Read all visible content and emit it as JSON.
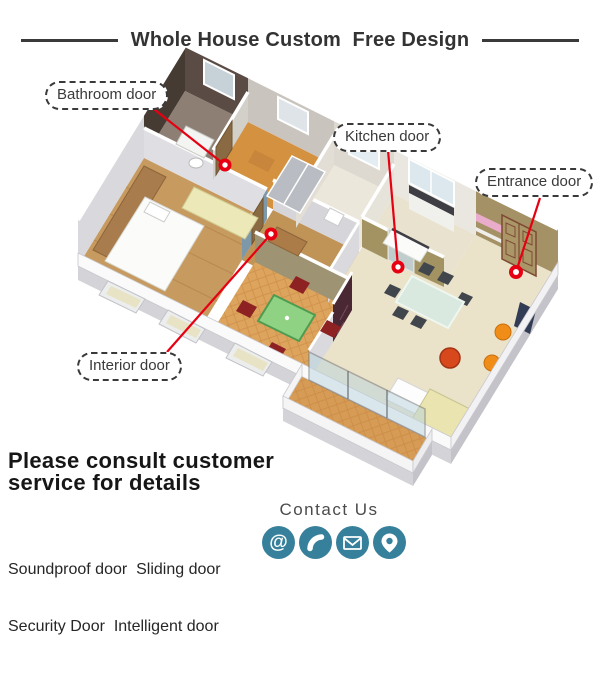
{
  "title": {
    "text": "Whole House Custom  Free Design"
  },
  "annotations": [
    {
      "id": "bathroom-door",
      "label": "Bathroom door"
    },
    {
      "id": "kitchen-door",
      "label": "Kitchen door"
    },
    {
      "id": "entrance-door",
      "label": "Entrance door"
    },
    {
      "id": "interior-door",
      "label": "Interior door"
    }
  ],
  "footer": {
    "heading_line1": "Please consult customer",
    "heading_line2": "service for details",
    "products_line1": "Soundproof door  Sliding door",
    "products_line2": "Security Door  Intelligent door"
  },
  "contact": {
    "label": "Contact Us",
    "icons": [
      {
        "name": "at-icon",
        "glyph": "@"
      },
      {
        "name": "phone-icon"
      },
      {
        "name": "email-icon"
      },
      {
        "name": "location-icon"
      }
    ]
  },
  "colors": {
    "accent_red": "#e60012",
    "icon_teal": "#37809b",
    "text_dark": "#333333"
  }
}
